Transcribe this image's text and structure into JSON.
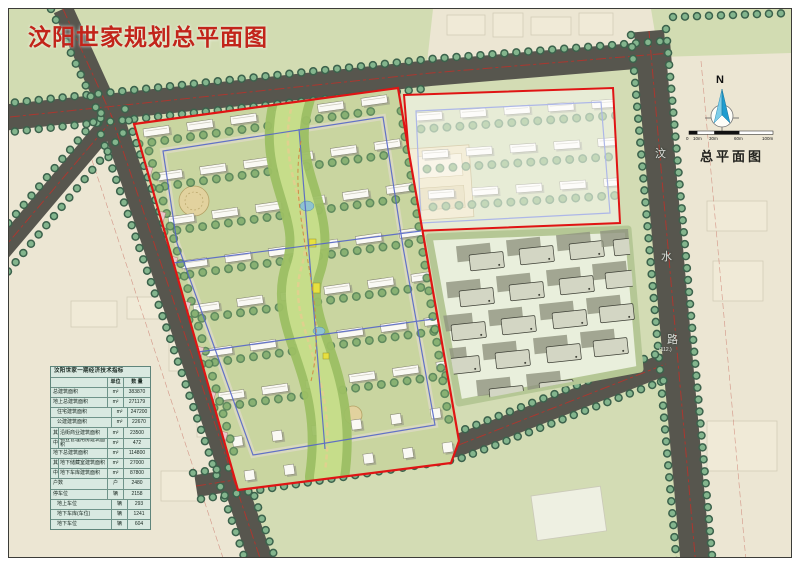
{
  "page": {
    "title": "汶阳世家规划总平面图"
  },
  "map": {
    "plan_label": "总平面图",
    "compass": {
      "label": "N"
    },
    "scale_bar": {
      "labels": [
        "0",
        "10m",
        "30m",
        "60m",
        "100m"
      ]
    },
    "road_label": {
      "chars": [
        "汶",
        "水",
        "路"
      ],
      "note": "(112.)"
    }
  },
  "table": {
    "title": "汶阳世家一期经济技术指标",
    "columns": {
      "label": "",
      "unit": "单位",
      "value": "数  量"
    },
    "rows": [
      {
        "label": "总建筑面积",
        "unit": "m²",
        "value": "383870",
        "indent": 0,
        "marker": ""
      },
      {
        "label": "地上总建筑面积",
        "unit": "m²",
        "value": "271179",
        "indent": 0,
        "marker": ""
      },
      {
        "label": "住宅建筑面积",
        "unit": "m²",
        "value": "247200",
        "indent": 1,
        "marker": ""
      },
      {
        "label": "公建建筑面积",
        "unit": "m²",
        "value": "22670",
        "indent": 1,
        "marker": ""
      },
      {
        "label": "沿街商业建筑面积",
        "unit": "m²",
        "value": "23500",
        "indent": 0,
        "marker": "其"
      },
      {
        "label": "物业管理用房建筑面积",
        "unit": "m²",
        "value": "472",
        "indent": 0,
        "marker": "中"
      },
      {
        "label": "地下总建筑面积",
        "unit": "m²",
        "value": "114800",
        "indent": 0,
        "marker": ""
      },
      {
        "label": "地下储藏室建筑面积",
        "unit": "m²",
        "value": "27000",
        "indent": 0,
        "marker": "其"
      },
      {
        "label": "地下车库建筑面积",
        "unit": "m²",
        "value": "87800",
        "indent": 0,
        "marker": "中"
      },
      {
        "label": "户数",
        "unit": "户",
        "value": "2480",
        "indent": 0,
        "marker": ""
      },
      {
        "label": "停车位",
        "unit": "辆",
        "value": "2158",
        "indent": 0,
        "marker": ""
      },
      {
        "label": "地上车位",
        "unit": "辆",
        "value": "293",
        "indent": 1,
        "marker": ""
      },
      {
        "label": "地下车库(车位)",
        "unit": "辆",
        "value": "1241",
        "indent": 1,
        "marker": ""
      },
      {
        "label": "地下车位",
        "unit": "辆",
        "value": "604",
        "indent": 1,
        "marker": ""
      }
    ]
  },
  "colors": {
    "title_red": "#c2241a",
    "boundary_red": "#e01414",
    "road_gray": "#57564e",
    "tree_green": "#6d9f79",
    "block_green": "#d2dcb2",
    "paper_beige": "#ece6d3",
    "table_bg": "#d9e9e1",
    "compass_blue": "#2aa7d8"
  }
}
